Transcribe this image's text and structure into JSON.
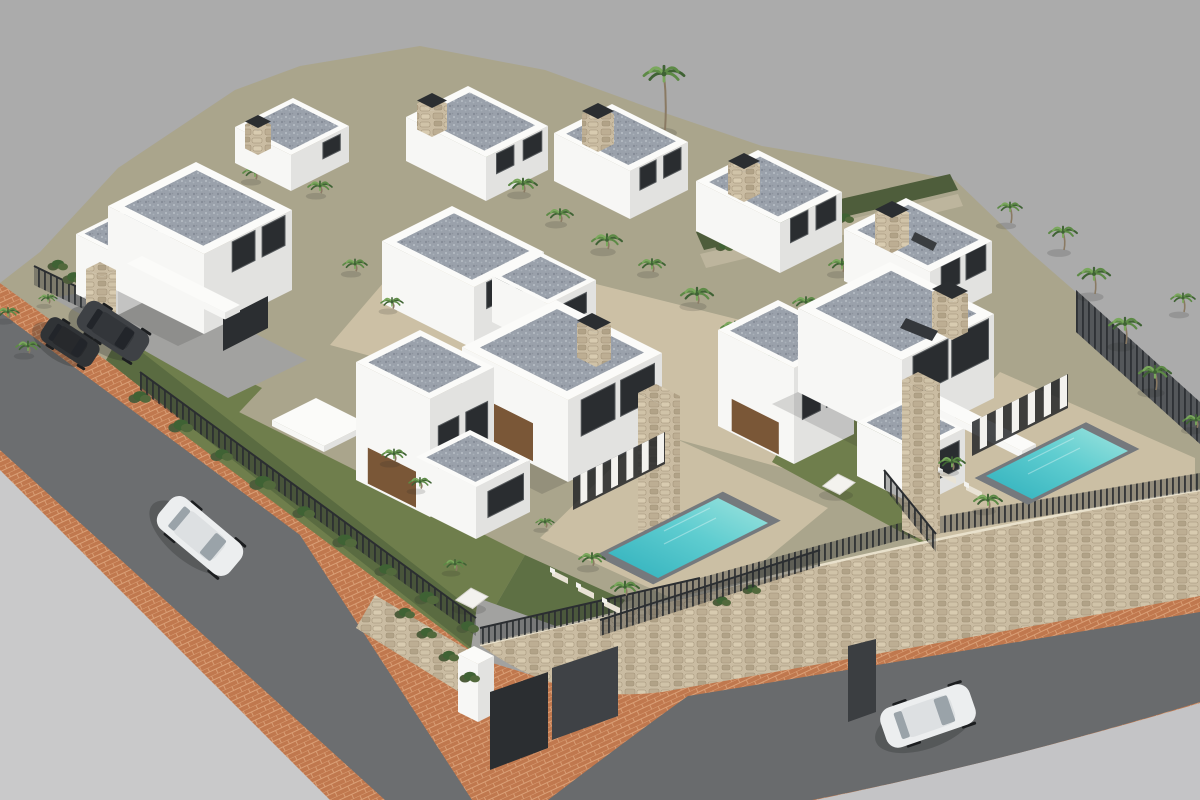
{
  "meta": {
    "title": "Aerial 3D architectural rendering of a modern white villa development with pools, palm trees, perimeter stone wall and surrounding asphalt roads",
    "type": "architectural-visualization",
    "view": "isometric aerial"
  },
  "scene": {
    "palette": {
      "bg": "#ababab",
      "ground_light": "#c9c9ca",
      "ground_light2": "#c4c4c6",
      "road": "#6c6e70",
      "road2": "#696b6d",
      "sidewalk": "#c0784e",
      "sidewalk_line": "#daa077",
      "site": "#aaa58c",
      "courtyard": "#ccc0a5",
      "grass": "#6f7e4c",
      "grass_dark": "#5e7044",
      "terrace": "#cbbfa4",
      "stone_base": "#cabca2",
      "stone_a": "#bdae93",
      "stone_b": "#d8cbb0",
      "stone_c": "#b1a287",
      "stone_d": "#d0c3a8",
      "stone_line": "#9f9076",
      "coping": "#e9e1cc",
      "fence": "#3b3e41",
      "fence_dark": "#2b2e31",
      "white_lit": "#f7f7f5",
      "white_shade": "#e2e2e0",
      "white_deep": "#cfcfcd",
      "parapet": "#fbfbf9",
      "gravel": "#9aa1ab",
      "gravel_dark": "#848b96",
      "gravel_light": "#b9bfc7",
      "window": "#2a2d30",
      "window_frame": "#55595c",
      "wood": "#7a5737",
      "pool_deep": "#2fb0bc",
      "pool_mid": "#5fcdd0",
      "pool_light": "#9fe4de",
      "pool_rim": "#75797d",
      "palm_dark": "#3f6234",
      "palm": "#5d8a46",
      "palm_light": "#7aa85c",
      "trunk": "#8a7a63",
      "hedge": "#4e5d3b",
      "gravel_path": "#bdb59d",
      "concrete": "#a2a2a0",
      "car_white": "#eceeef",
      "car_white_roof": "#dde0e2",
      "car_dark": "#3e4145",
      "car_dark2": "#303336",
      "car_roof_dark": "#33363a",
      "glass": "#9aa3a9",
      "glass_dark": "#22252a",
      "wheel": "#1c1e20",
      "canopy": "#f3f2ee",
      "lounger": "#e9e3d5",
      "shadow": "rgba(35,38,40,0.28)",
      "shadow_soft": "rgba(35,38,40,0.16)"
    },
    "inventory": {
      "villas": {
        "count": 9,
        "style": "two-storey white modern cubic villas, flat gravel roofs with white parapets, stone-clad chimneys and pillars, dark glazing, wood accents"
      },
      "pools": {
        "count": 2,
        "water_color": "turquoise",
        "surround": "tan paved terraces with sun loungers"
      },
      "cars": [
        {
          "id": "suv-dark-1",
          "color": "dark grey",
          "location": "entrance driveway, top-left"
        },
        {
          "id": "suv-dark-2",
          "color": "black",
          "location": "entrance driveway, top-left"
        },
        {
          "id": "suv-white-1",
          "color": "white",
          "location": "left road"
        },
        {
          "id": "suv-white-2",
          "color": "white",
          "location": "bottom road"
        }
      ],
      "vegetation": {
        "palm_trees": 38,
        "hedges": "along fences and lanes"
      },
      "roads": {
        "surface": "dark asphalt",
        "sidewalks": "terracotta brick pavers"
      },
      "perimeter": {
        "wall": "natural stone retaining wall",
        "fence": "dark metal picket fence",
        "gates": "anthracite panels at street corner"
      }
    }
  }
}
